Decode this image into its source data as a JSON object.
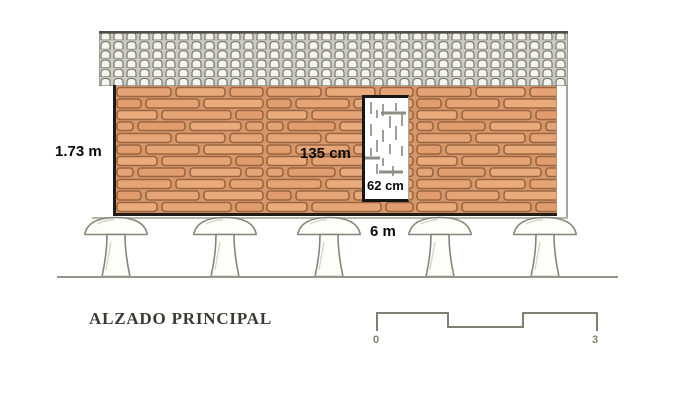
{
  "drawing": {
    "title": "ALZADO PRINCIPAL",
    "labels": {
      "wall_height": "1.73 m",
      "opening_height": "135 cm",
      "opening_width": "62 cm",
      "building_width": "6 m"
    },
    "scale": {
      "start": "0",
      "end": "3"
    }
  },
  "colors": {
    "brick_fill": "#e5a475",
    "brick_mortar": "#d6976a",
    "brick_line": "#9a6641",
    "roof_tile_fill": "#f5f5f0",
    "roof_tile_line": "#6e6e66",
    "roof_gap": "#cbcbc2",
    "sketch_line": "#85857a",
    "edge_black": "#1c1c1c",
    "label_text": "#0a0a0a",
    "title_text": "#3a3a33"
  }
}
